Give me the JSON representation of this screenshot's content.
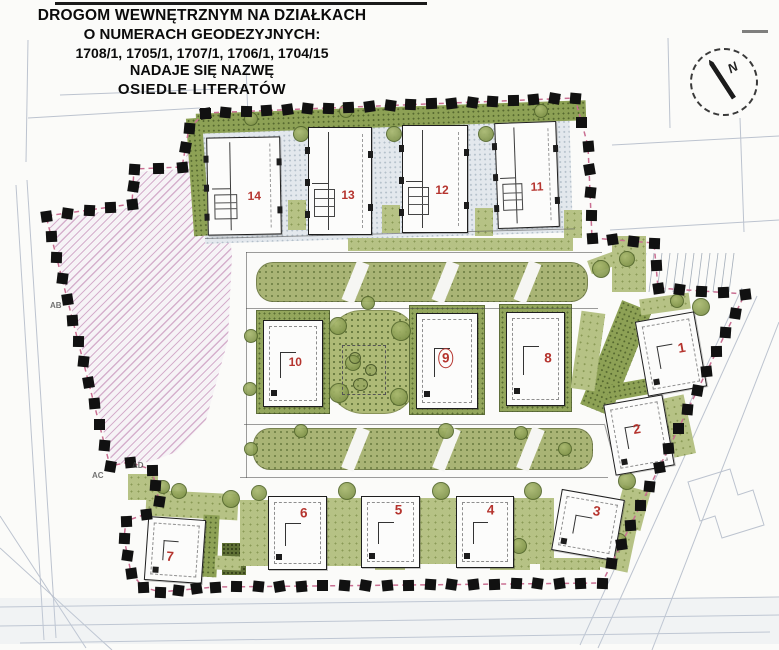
{
  "title": {
    "lines": [
      "DROGOM WEWNĘTRZNYM NA DZIAŁKACH",
      "O NUMERACH GEODEZYJNYCH:",
      "1708/1, 1705/1, 1707/1, 1706/1, 1704/15",
      "NADAJE SIĘ NAZWĘ",
      "OSIEDLE LITERATÓW"
    ]
  },
  "compass": {
    "label": "N"
  },
  "map": {
    "buildings": [
      {
        "label": "1",
        "x": 641,
        "y": 316,
        "w": 58,
        "h": 74,
        "rot": -10,
        "type": "square",
        "nx": 70,
        "ny": 44,
        "circled": false
      },
      {
        "label": "2",
        "x": 609,
        "y": 399,
        "w": 58,
        "h": 70,
        "rot": -10,
        "type": "square",
        "nx": 48,
        "ny": 42,
        "circled": false
      },
      {
        "label": "3",
        "x": 556,
        "y": 494,
        "w": 62,
        "h": 60,
        "rot": 10,
        "type": "square",
        "nx": 60,
        "ny": 25,
        "circled": false
      },
      {
        "label": "4",
        "x": 456,
        "y": 496,
        "w": 56,
        "h": 70,
        "rot": 0,
        "type": "square",
        "nx": 60,
        "ny": 18,
        "circled": false
      },
      {
        "label": "5",
        "x": 361,
        "y": 496,
        "w": 57,
        "h": 70,
        "rot": 0,
        "type": "square",
        "nx": 64,
        "ny": 18,
        "circled": false
      },
      {
        "label": "6",
        "x": 268,
        "y": 496,
        "w": 57,
        "h": 72,
        "rot": 0,
        "type": "square",
        "nx": 61,
        "ny": 22,
        "circled": false
      },
      {
        "label": "7",
        "x": 146,
        "y": 518,
        "w": 56,
        "h": 62,
        "rot": 4,
        "type": "square",
        "nx": 42,
        "ny": 62,
        "circled": false
      },
      {
        "label": "8",
        "x": 506,
        "y": 312,
        "w": 57,
        "h": 92,
        "rot": 0,
        "type": "square",
        "nx": 72,
        "ny": 49,
        "circled": false
      },
      {
        "label": "9",
        "x": 416,
        "y": 313,
        "w": 60,
        "h": 94,
        "rot": 0,
        "type": "square",
        "nx": 48,
        "ny": 47,
        "circled": true
      },
      {
        "label": "10",
        "x": 263,
        "y": 320,
        "w": 58,
        "h": 85,
        "rot": 0,
        "type": "square",
        "nx": 54,
        "ny": 48,
        "circled": false
      },
      {
        "label": "11",
        "x": 496,
        "y": 122,
        "w": 60,
        "h": 104,
        "rot": -2,
        "type": "tall",
        "nx": 66,
        "ny": 62,
        "circled": false
      },
      {
        "label": "12",
        "x": 402,
        "y": 125,
        "w": 64,
        "h": 106,
        "rot": 0,
        "type": "tall",
        "nx": 61,
        "ny": 60,
        "circled": false
      },
      {
        "label": "13",
        "x": 308,
        "y": 127,
        "w": 62,
        "h": 106,
        "rot": 0,
        "type": "tall",
        "nx": 63,
        "ny": 63,
        "circled": false
      },
      {
        "label": "14",
        "x": 207,
        "y": 137,
        "w": 72,
        "h": 96,
        "rot": -1,
        "type": "tall",
        "nx": 64,
        "ny": 60,
        "circled": false
      }
    ],
    "boundary": {
      "points": [
        [
          205,
          113
        ],
        [
          575,
          98
        ],
        [
          588,
          146
        ],
        [
          592,
          238
        ],
        [
          654,
          243
        ],
        [
          658,
          288
        ],
        [
          745,
          294
        ],
        [
          602,
          583
        ],
        [
          215,
          587
        ],
        [
          160,
          592
        ],
        [
          143,
          587
        ],
        [
          131,
          573
        ],
        [
          124,
          538
        ],
        [
          126,
          521
        ],
        [
          146,
          514
        ],
        [
          159,
          501
        ],
        [
          152,
          470
        ],
        [
          130,
          462
        ],
        [
          110,
          466
        ],
        [
          46,
          216
        ],
        [
          132,
          204
        ],
        [
          134,
          169
        ],
        [
          182,
          167
        ],
        [
          189,
          128
        ],
        [
          205,
          113
        ]
      ],
      "labels": [
        {
          "text": "AB",
          "x": 50,
          "y": 301
        },
        {
          "text": "AC",
          "x": 92,
          "y": 471
        },
        {
          "text": "AD",
          "x": 132,
          "y": 461
        }
      ]
    }
  },
  "colors": {
    "building_number_red": "#b5342e",
    "boundary_line_pink": "#c96f92",
    "boundary_marker_black": "#111111",
    "greenery": "#aeb97a",
    "hatch_pink": "#c08ab4",
    "stipple_ground": "#e3e8ed"
  }
}
